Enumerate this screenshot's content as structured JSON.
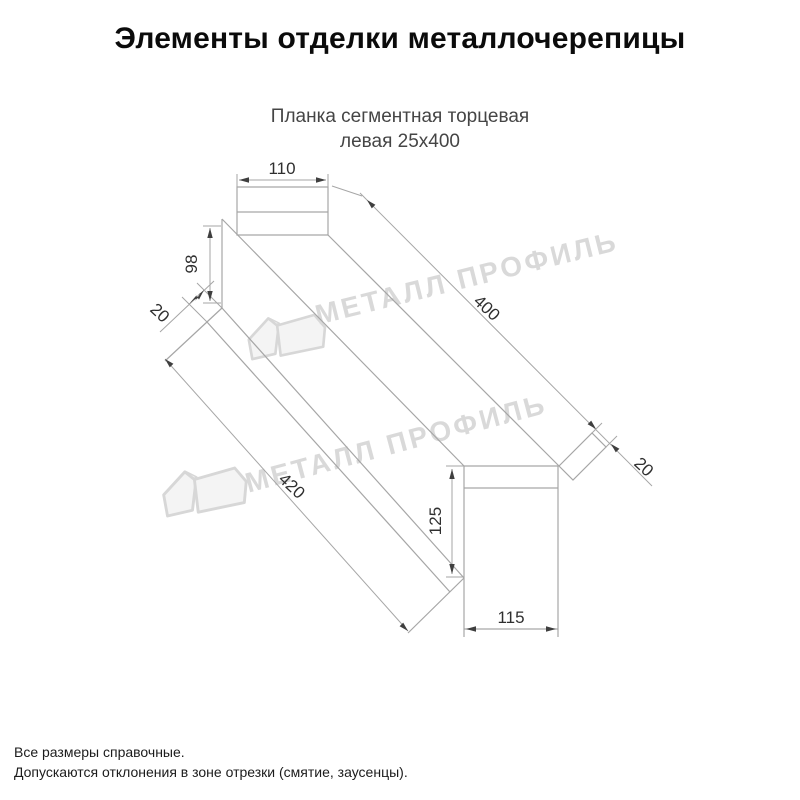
{
  "header": {
    "title": "Элементы отделки металлочерепицы"
  },
  "product": {
    "subtitle_line1": "Планка сегментная торцевая",
    "subtitle_line2": "левая 25х400"
  },
  "drawing": {
    "type": "technical-sketch",
    "description": "3D sketch of left segmental end strip with dimension callouts",
    "line_color": "#a6a6a6",
    "dim_text_color": "#2f2f2f",
    "dims": {
      "top_flange_width": {
        "label": "110",
        "value": 110
      },
      "web_height": {
        "label": "98",
        "value": 98
      },
      "hem_near": {
        "label": "20",
        "value": 20
      },
      "length_top": {
        "label": "400",
        "value": 400
      },
      "length_bottom": {
        "label": "420",
        "value": 420
      },
      "hem_far": {
        "label": "20",
        "value": 20
      },
      "end_height": {
        "label": "125",
        "value": 125
      },
      "end_width": {
        "label": "115",
        "value": 115
      }
    }
  },
  "watermark": {
    "text": "МЕТАЛЛ ПРОФИЛЬ",
    "color": "#d9d9d9",
    "logo": "metall-profil-house-logo"
  },
  "footer": {
    "note1": "Все размеры справочные.",
    "note2": "Допускаются отклонения в зоне отрезки (смятие, заусенцы)."
  }
}
